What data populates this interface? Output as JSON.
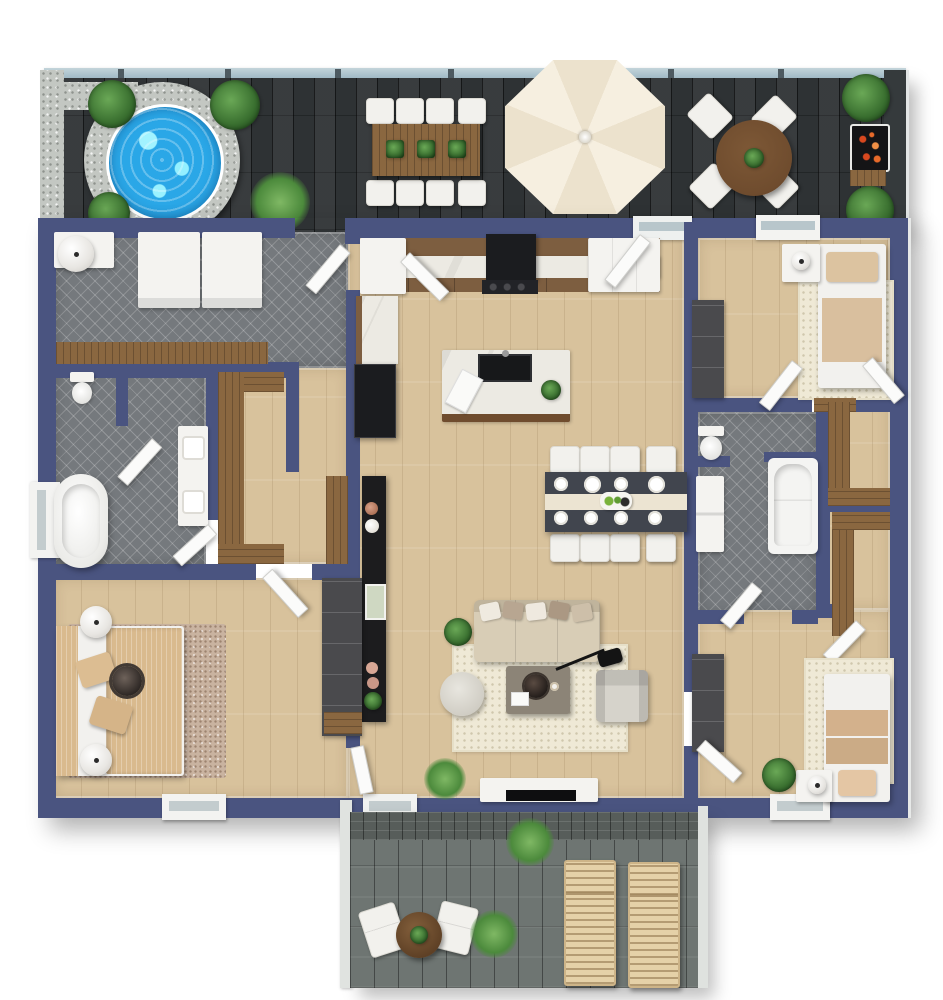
{
  "scene": {
    "type": "3d-floor-plan-top-view",
    "description": "Top-down 3D architectural rendering of a single-storey home with an upper dark timber roof deck and a lower grey timber patio",
    "rooms": [
      {
        "name": "upper-deck-patio",
        "floor": "dark-timber-boards",
        "features": [
          "hot-tub",
          "outdoor-dining-table-8-seats",
          "patio-umbrella",
          "round-cafe-table-4-chairs",
          "bbq-grill",
          "glass-balustrade",
          "gravel-border",
          "potted-plants"
        ]
      },
      {
        "name": "laundry-room",
        "floor": "grey-herringbone-tile",
        "features": [
          "washer",
          "dryer",
          "corner-cabinet",
          "round-laundry-hamper",
          "timber-folding-counter"
        ]
      },
      {
        "name": "kitchen",
        "floor": "light-oak-plank",
        "features": [
          "wall-counter-run",
          "range-with-hood",
          "corner-pantry",
          "refrigerator",
          "island-with-double-sink",
          "cutting-board",
          "herb-plant"
        ]
      },
      {
        "name": "bedroom-top-right",
        "floor": "light-oak-plank",
        "features": [
          "single-bed",
          "nightstand",
          "table-lamp",
          "dresser",
          "dotted-rug",
          "window"
        ]
      },
      {
        "name": "bathroom-left",
        "floor": "grey-herringbone-tile",
        "features": [
          "freestanding-tub",
          "toilet",
          "double-vanity",
          "shower",
          "window"
        ]
      },
      {
        "name": "walk-in-closet-left",
        "floor": "light-oak-plank",
        "features": [
          "u-shaped-timber-wardrobe"
        ]
      },
      {
        "name": "dining-area",
        "floor": "light-oak-plank",
        "features": [
          "table-for-8",
          "table-runner",
          "place-settings",
          "centerpiece"
        ]
      },
      {
        "name": "living-room",
        "floor": "light-oak-plank",
        "features": [
          "sofa-with-pillows",
          "coffee-table",
          "round-pouf",
          "armchair",
          "arc-floor-lamp",
          "tv-console",
          "black-sideboard",
          "cream-rug",
          "plants"
        ]
      },
      {
        "name": "master-bedroom",
        "floor": "light-oak-plank",
        "features": [
          "double-bed",
          "two-ball-lamps",
          "speckled-rug",
          "dark-wardrobe",
          "windows"
        ]
      },
      {
        "name": "bathroom-right",
        "floor": "grey-herringbone-tile",
        "features": [
          "built-in-tub",
          "toilet",
          "vanity"
        ]
      },
      {
        "name": "closet-hall-right",
        "floor": "light-oak-plank",
        "features": [
          "timber-wardrobes"
        ]
      },
      {
        "name": "bedroom-bottom-right",
        "floor": "light-oak-plank",
        "features": [
          "single-bed",
          "nightstand",
          "table-lamp",
          "dresser",
          "dotted-rug",
          "plant"
        ]
      },
      {
        "name": "lower-deck-patio",
        "floor": "grey-timber-boards",
        "features": [
          "two-sun-loungers",
          "two-armchairs",
          "round-side-table",
          "grass-plants"
        ]
      }
    ],
    "palette": {
      "wall": "#4a5480",
      "wallEdge": "#39426b",
      "floorWood": "#d8c29c",
      "tile": "#75797d",
      "deckDark": "#2e3234",
      "deckGray": "#6e7572",
      "brick": "#575d5a",
      "glass": "#9db7c4",
      "gravel": "#c3c7c2",
      "water": "#2aa7e7",
      "marble": "#eceae3",
      "cabinetWood": "#7d5e40",
      "woodMed": "#8a6740",
      "woodDark": "#6f4c2e",
      "applianceBlack": "#1b1c1f",
      "white": "#f4f3f0",
      "chairWhite": "#f2f1ed",
      "cream": "#f4ecdc",
      "tan": "#d9ba8e",
      "slate": "#41454e",
      "runner": "#ece4d2",
      "rugCream": "#efe9d6",
      "rugTan": "#c9b3a0",
      "sofa": "#d8cdb6",
      "charcoalFurn": "#4a4a4d",
      "green": "#3f7d38",
      "fire": "#d8481f",
      "lounger": "#e5d1a8"
    }
  }
}
